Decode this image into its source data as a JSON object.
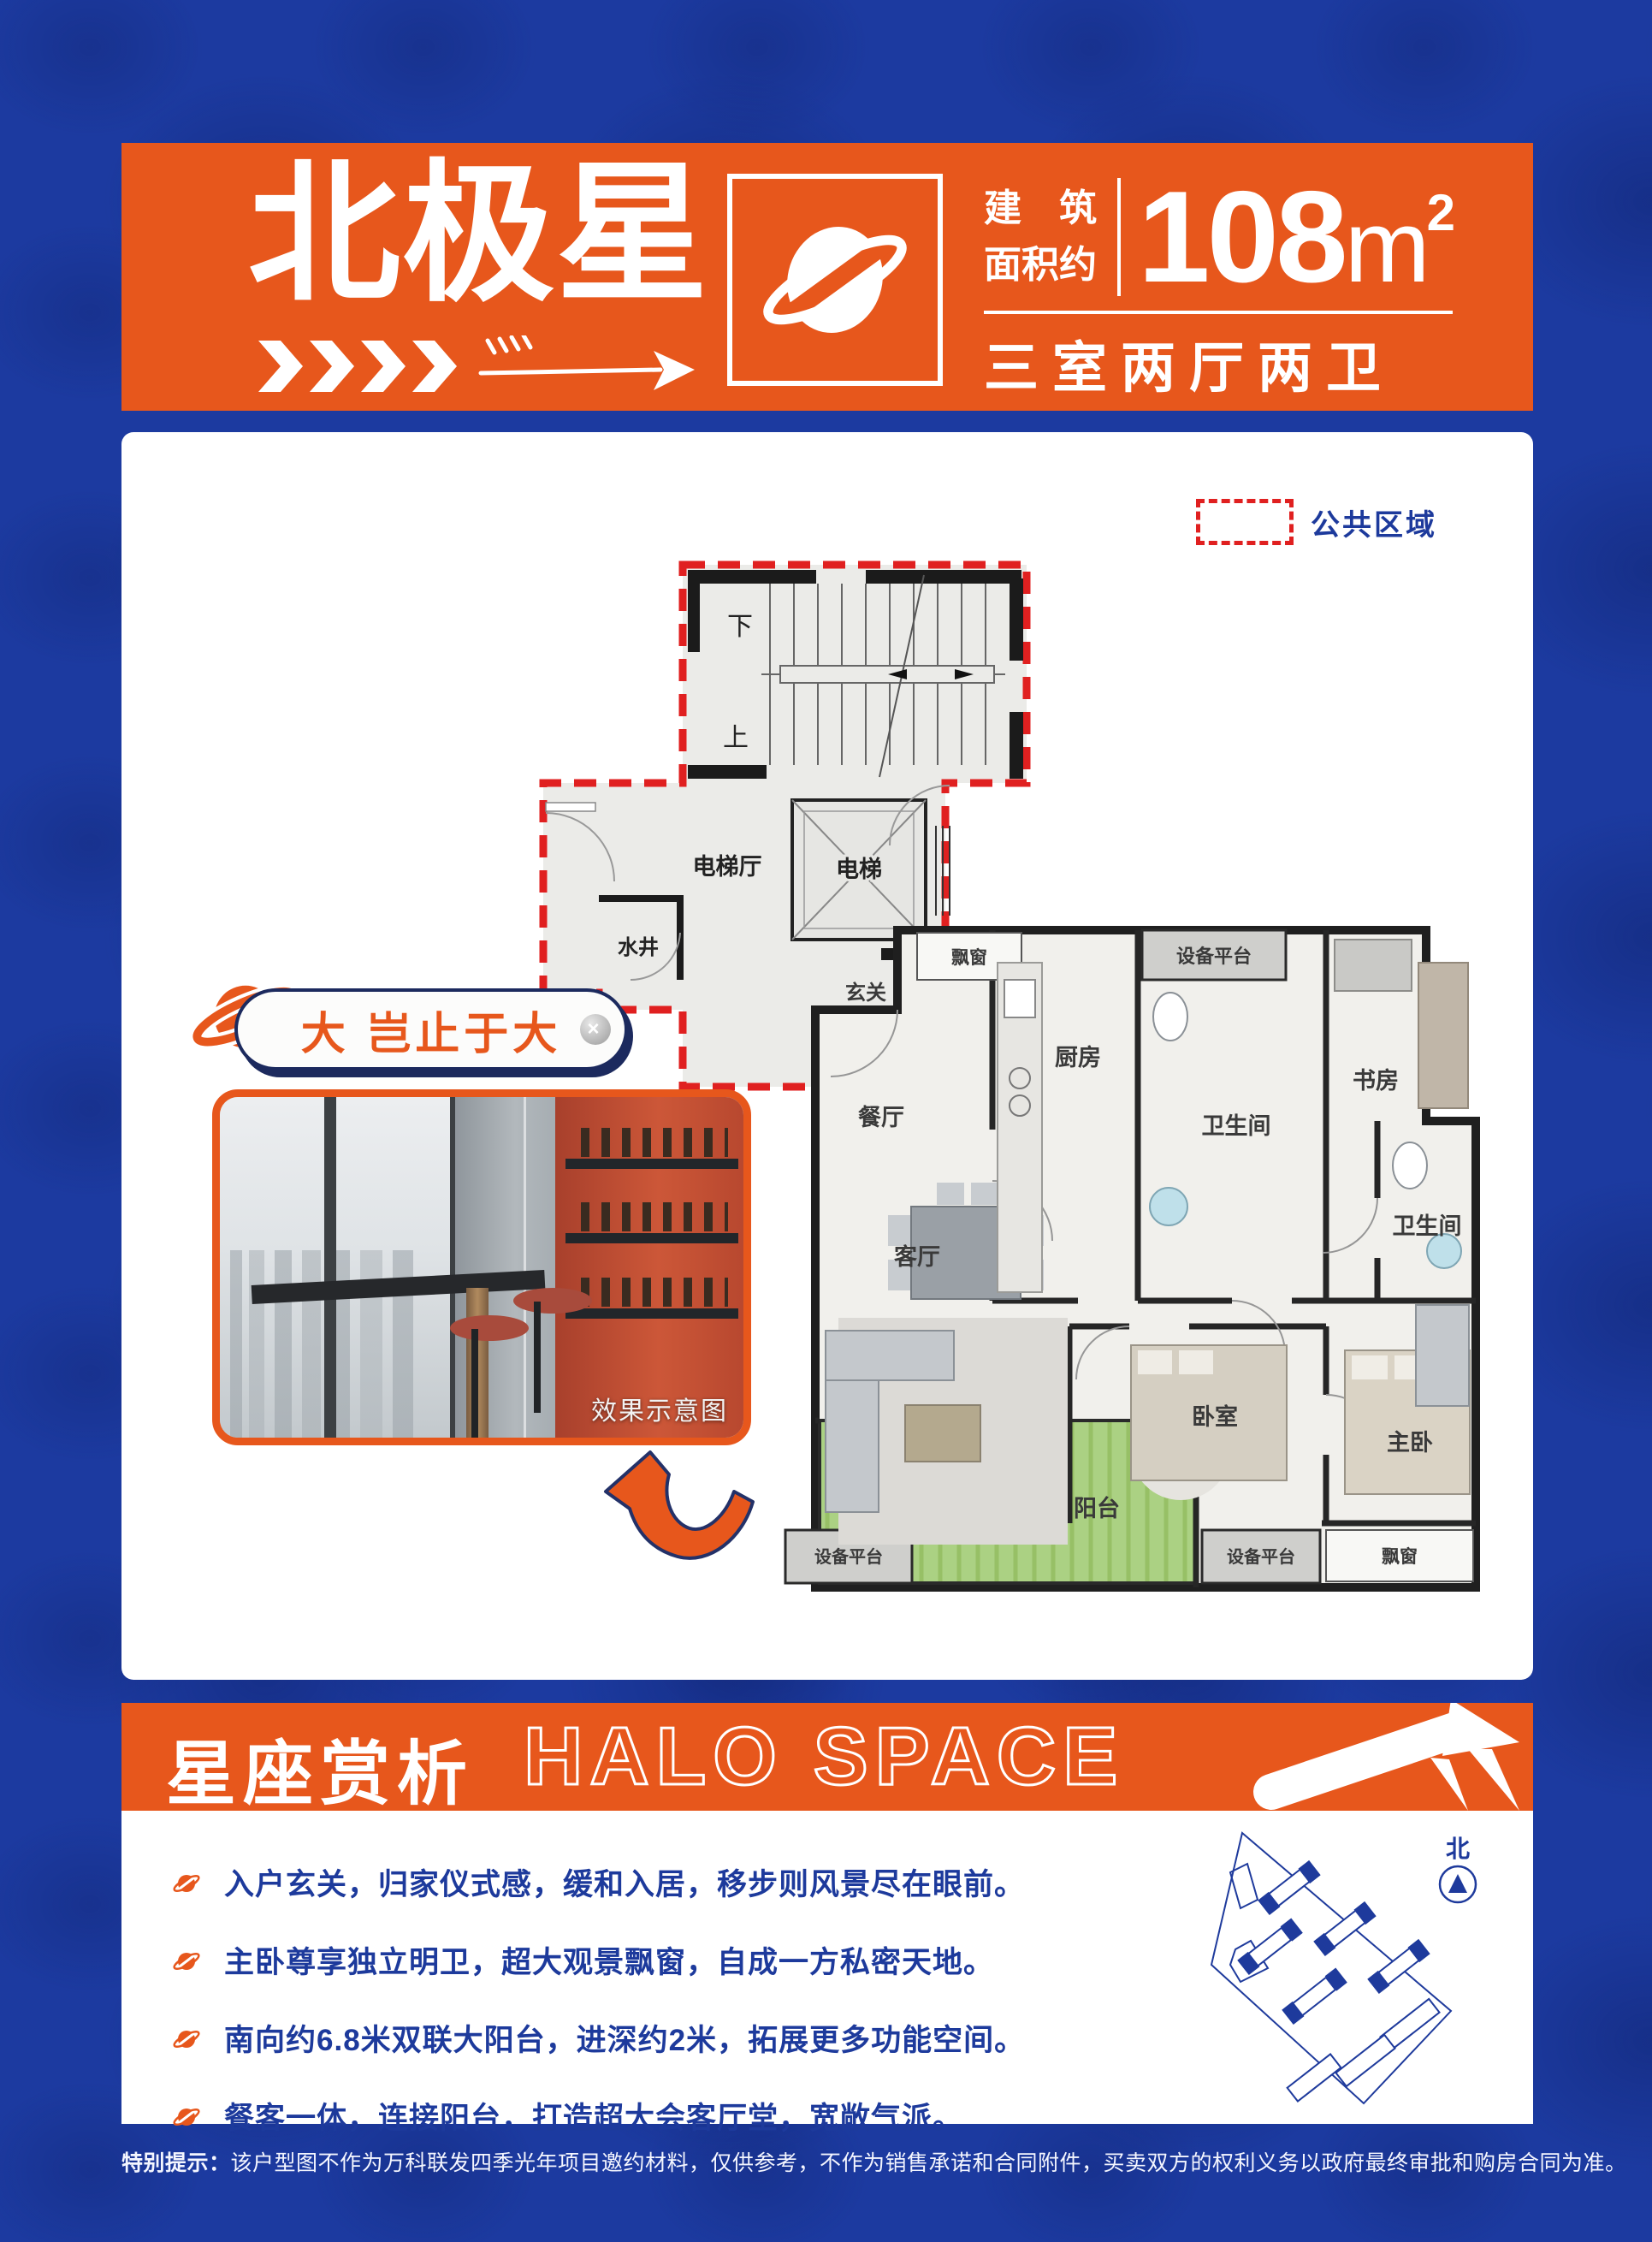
{
  "colors": {
    "orange": "#e7571c",
    "blue_bg": "#1c3aa0",
    "navy_text": "#1d3a9c",
    "red_dash": "#e02020"
  },
  "header": {
    "title": "北极星",
    "area_label_line1": "建筑",
    "area_label_line2": "面积约",
    "area_value": "108",
    "area_unit": "m",
    "area_sup": "2",
    "layout": "三室两厅两卫"
  },
  "legend": {
    "label": "公共区域"
  },
  "floorplan": {
    "labels": {
      "down": "下",
      "up": "上",
      "elevator_hall": "电梯厅",
      "elevator": "电梯",
      "water_well": "水井",
      "entry": "玄关",
      "bay_top": "飘窗",
      "kitchen": "厨房",
      "equip_top": "设备平台",
      "bath_top": "卫生间",
      "study": "书房",
      "dining": "餐厅",
      "living": "客厅",
      "bedroom": "卧室",
      "master": "主卧",
      "bath_right": "卫生间",
      "balcony": "阳台",
      "equip_bl": "设备平台",
      "equip_bm": "设备平台",
      "bay_br": "飘窗"
    }
  },
  "badge": {
    "text": "大 岂止于大",
    "screw": "×"
  },
  "photo": {
    "caption": "效果示意图"
  },
  "halo": {
    "title_cn": "星座赏析",
    "title_en": "HALO SPACE"
  },
  "features": [
    {
      "text": "入户玄关，归家仪式感，缓和入居，移步则风景尽在眼前。"
    },
    {
      "text": "主卧尊享独立明卫，超大观景飘窗，自成一方私密天地。"
    },
    {
      "text": "南向约6.8米双联大阳台，进深约2米，拓展更多功能空间。"
    },
    {
      "text": "餐客一体，连接阳台，打造超大会客厅堂，宽敞气派。"
    }
  ],
  "sitemap": {
    "north": "北"
  },
  "disclaimer": {
    "prefix": "特别提示：",
    "body": "该户型图不作为万科联发四季光年项目邀约材料，仅供参考，不作为销售承诺和合同附件，买卖双方的权利义务以政府最终审批和购房合同为准。"
  }
}
